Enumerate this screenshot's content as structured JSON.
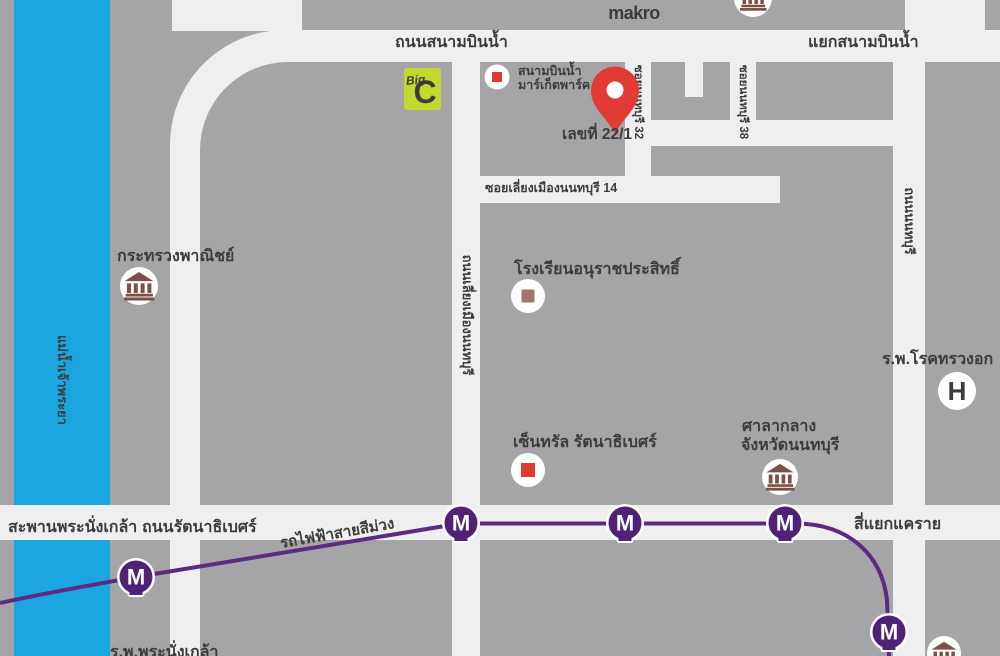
{
  "map": {
    "colors": {
      "background": "#a5a5a7",
      "road": "#f0eff0",
      "river": "#1ba6e2",
      "river_label": "#163450",
      "label": "#3c3c3e",
      "metro_purple": "#5b2b80",
      "metro_station": "#4f2276",
      "pin_red": "#e23a34",
      "makro_red": "#e2231a",
      "bigc_green": "#c3d82e",
      "bigc_red": "#e4202a",
      "bigc_yellow": "#ffe800",
      "bank_brown": "#7b5047",
      "square_red": "#e0392e",
      "school_brown": "#a1756c",
      "hospital_red": "#e4352b"
    },
    "labels": {
      "top_road": "ถนนสนามบินน้ำ",
      "top_junction": "แยกสนามบินน้ำ",
      "makro": "makro",
      "bigc_c": "C",
      "bigc_big": "Big",
      "market_line1": "สนามบินน้ำ",
      "market_line2": "มาร์เก็ตพาร์ค",
      "pin": "เลขที่ 22/1",
      "soi32": "ซอยนนทบุรี 32",
      "soi38": "ซอยนนทบุรี 38",
      "soi14": "ซอยเลี่ยงเมืองนนทบุรี 14",
      "bypass_road": "ถนนเลี่ยงเมืองนนทบุรี",
      "nonthaburi_road": "ถนนนนทบุรี",
      "ministry": "กระทรวงพาณิชย์",
      "school": "โรงเรียนอนุราชประสิทธิ์",
      "central": "เซ็นทรัล รัตนาธิเบศร์",
      "city_hall_1": "ศาลากลาง",
      "city_hall_2": "จังหวัดนนทบุรี",
      "chest_hospital": "ร.พ.โรคทรวงอก",
      "hospital_h": "H",
      "bridge": "สะพานพระนั่งเกล้า",
      "rattanathibet_road": "ถนนรัตนาธิเบศร์",
      "purple_line": "รถไฟฟ้าสายสีม่วง",
      "khae_rai": "สี่แยกแคราย",
      "river": "แม่น้ำเจ้าพระยา",
      "nangklao_hospital": "ร.พ.พระนั่งเกล้า",
      "metro_m": "M"
    }
  }
}
